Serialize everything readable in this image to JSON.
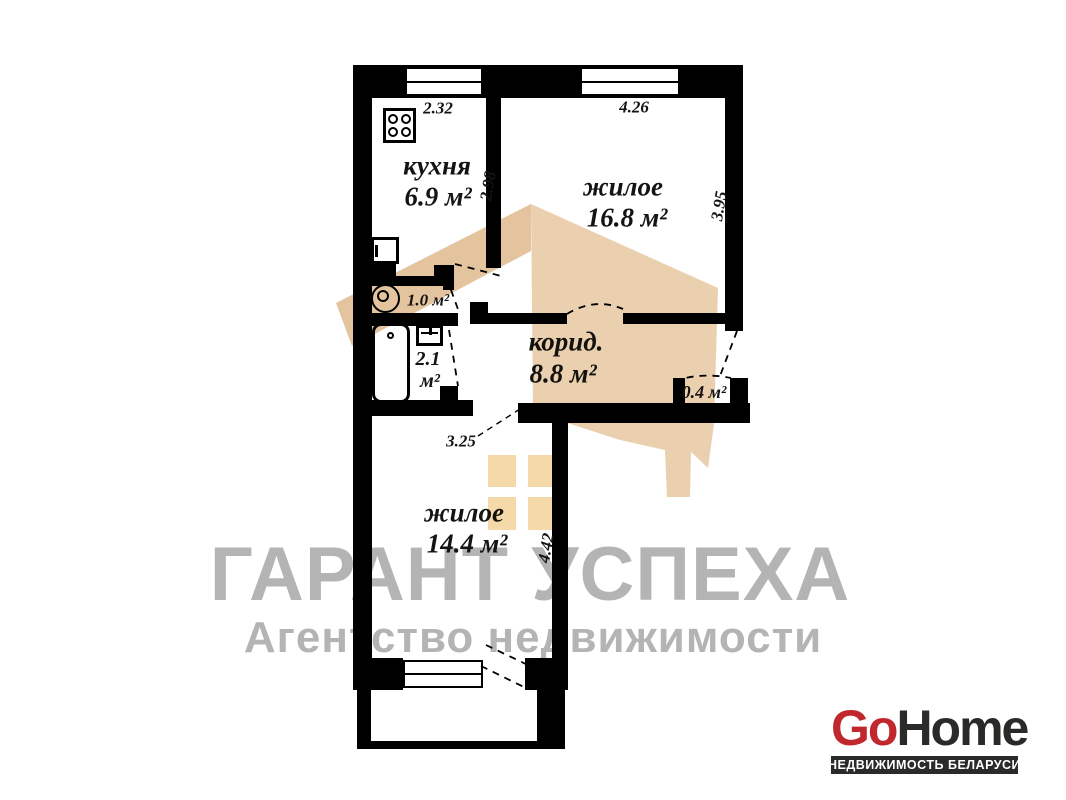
{
  "agency_watermark": {
    "title": "ГАРАНТ УСПЕХА",
    "subtitle": "Агентство недвижимости",
    "color": "#b4b4b4"
  },
  "logo": {
    "part1": "Go",
    "part2": "Home",
    "tagline": "НЕДВИЖИМОСТЬ БЕЛАРУСИ",
    "red": "#c0282e",
    "dark": "#2b2a29"
  },
  "floor_plan": {
    "wall_color": "#000000",
    "house_watermark_color": "#e3c49e",
    "house_watermark_body_color": "#ead0ae",
    "house_watermark_window_color": "#f5d9a9",
    "rooms": {
      "kitchen": {
        "label": "кухня",
        "area": "6.9 м²",
        "width": "2.32",
        "depth": "2.98"
      },
      "living_room_top": {
        "label": "жилое",
        "area": "16.8 м²",
        "width": "4.26",
        "depth": "3.95"
      },
      "corridor": {
        "label": "корид.",
        "area": "8.8 м²"
      },
      "living_room_bottom": {
        "label": "жилое",
        "area": "14.4 м²",
        "width": "3.25",
        "depth": "4.42"
      },
      "bathroom": {
        "area_value": "2.1",
        "area_unit": "м²"
      },
      "toilet": {
        "area": "1.0 м²"
      },
      "storage": {
        "area": "0.4 м²"
      }
    }
  }
}
